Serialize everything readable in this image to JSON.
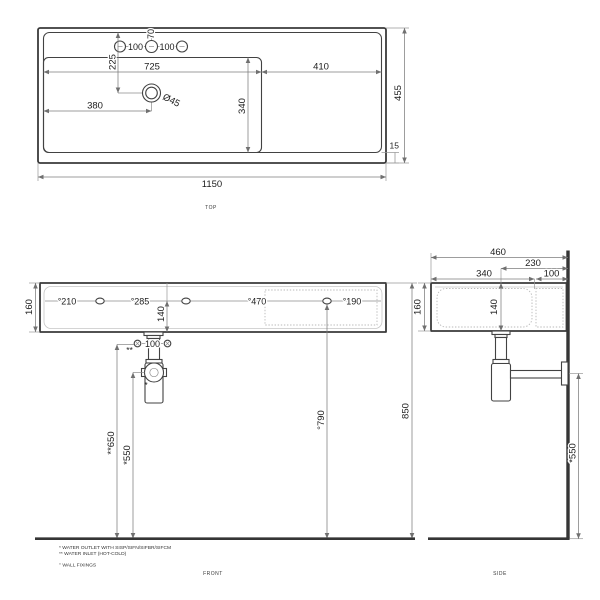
{
  "views": {
    "top": {
      "caption": "TOP",
      "dims": {
        "overall_width": "1150",
        "overall_depth": "455",
        "basin_width": "725",
        "right_deck_width": "410",
        "basin_depth": "340",
        "bottom_gap": "15",
        "tap_hole_inset": "70",
        "tap_spacing_left": "100",
        "tap_spacing_right": "100",
        "drain_offset_top": "225",
        "drain_offset_left": "380",
        "drain_diameter": "Ø45"
      }
    },
    "front": {
      "caption": "FRONT",
      "dims": {
        "height": "160",
        "fixing_offset_left": "°210",
        "fixing_spacing_mid": "°285",
        "fixing_spacing_right": "°470",
        "fixing_offset_right": "°190",
        "drain_depth": "140",
        "inlet_spacing": "100",
        "inlet_marker": "**",
        "outlet_marker": "*",
        "inlet_height": "**650",
        "outlet_height": "*550",
        "fixing_height": "°790",
        "total_height": "850"
      }
    },
    "side": {
      "caption": "SIDE",
      "dims": {
        "overall_depth": "460",
        "drain_to_wall": "230",
        "basin_depth": "340",
        "back_ledge": "100",
        "height": "160",
        "drain_depth": "140",
        "outlet_height": "*550"
      }
    }
  },
  "legend": {
    "items": [
      "* WATER OUTLET WITH SISP/SIFN/SIFBR/SIFCM",
      "** WATER INLET (HOT-COLD)",
      "° WALL FIXINGS"
    ]
  },
  "colors": {
    "line": "#3a3a3a",
    "dimension": "#7d7d7d",
    "text": "#1c1c1c",
    "background": "#ffffff"
  }
}
